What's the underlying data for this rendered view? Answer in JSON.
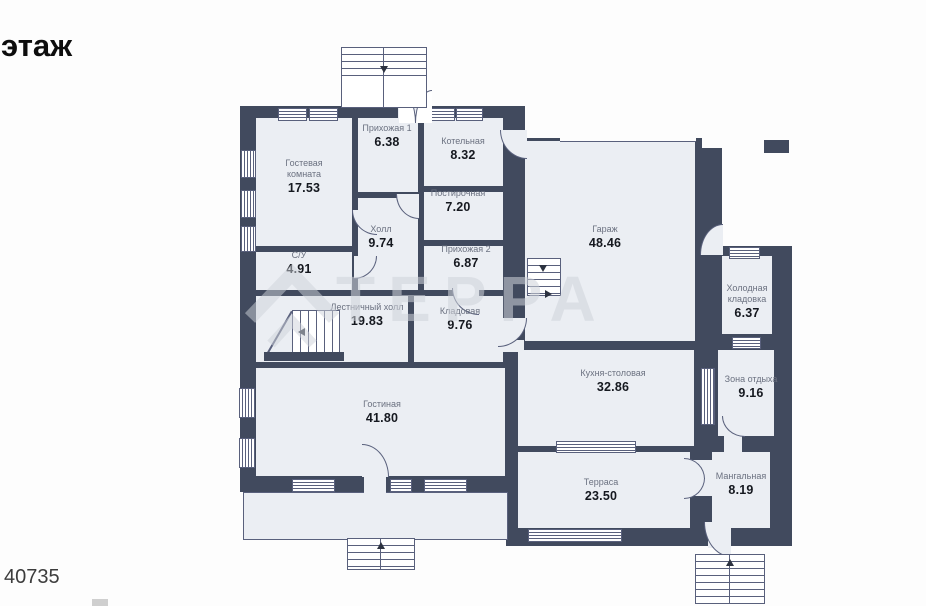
{
  "page": {
    "floor_label": "этаж",
    "plan_number": "40735"
  },
  "watermark": {
    "text": "ТЕРРА"
  },
  "colors": {
    "wall": "#414a5e",
    "room_fill": "#ebeef3",
    "window": "#ffffff",
    "label_text": "#6b7180",
    "area_text": "#15181f",
    "watermark": "#cfd3da"
  },
  "rooms": [
    {
      "id": "guest-room",
      "name": "Гостевая комната",
      "area": "17.53"
    },
    {
      "id": "hallway-1",
      "name": "Прихожая 1",
      "area": "6.38"
    },
    {
      "id": "boiler-room",
      "name": "Котельная",
      "area": "8.32"
    },
    {
      "id": "laundry",
      "name": "Постирочная",
      "area": "7.20"
    },
    {
      "id": "hall",
      "name": "Холл",
      "area": "9.74"
    },
    {
      "id": "wc",
      "name": "С/У",
      "area": "4.91"
    },
    {
      "id": "hallway-2",
      "name": "Прихожая 2",
      "area": "6.87"
    },
    {
      "id": "garage",
      "name": "Гараж",
      "area": "48.46"
    },
    {
      "id": "stair-hall",
      "name": "Лестничный холл",
      "area": "19.83"
    },
    {
      "id": "storage",
      "name": "Кладовая",
      "area": "9.76"
    },
    {
      "id": "cold-pantry",
      "name": "Холодная кладовка",
      "area": "6.37"
    },
    {
      "id": "kitchen-dining",
      "name": "Кухня-столовая",
      "area": "32.86"
    },
    {
      "id": "rest-zone",
      "name": "Зона отдыха",
      "area": "9.16"
    },
    {
      "id": "living-room",
      "name": "Гостиная",
      "area": "41.80"
    },
    {
      "id": "terrace",
      "name": "Терраса",
      "area": "23.50"
    },
    {
      "id": "bbq-room",
      "name": "Мангальная",
      "area": "8.19"
    }
  ]
}
